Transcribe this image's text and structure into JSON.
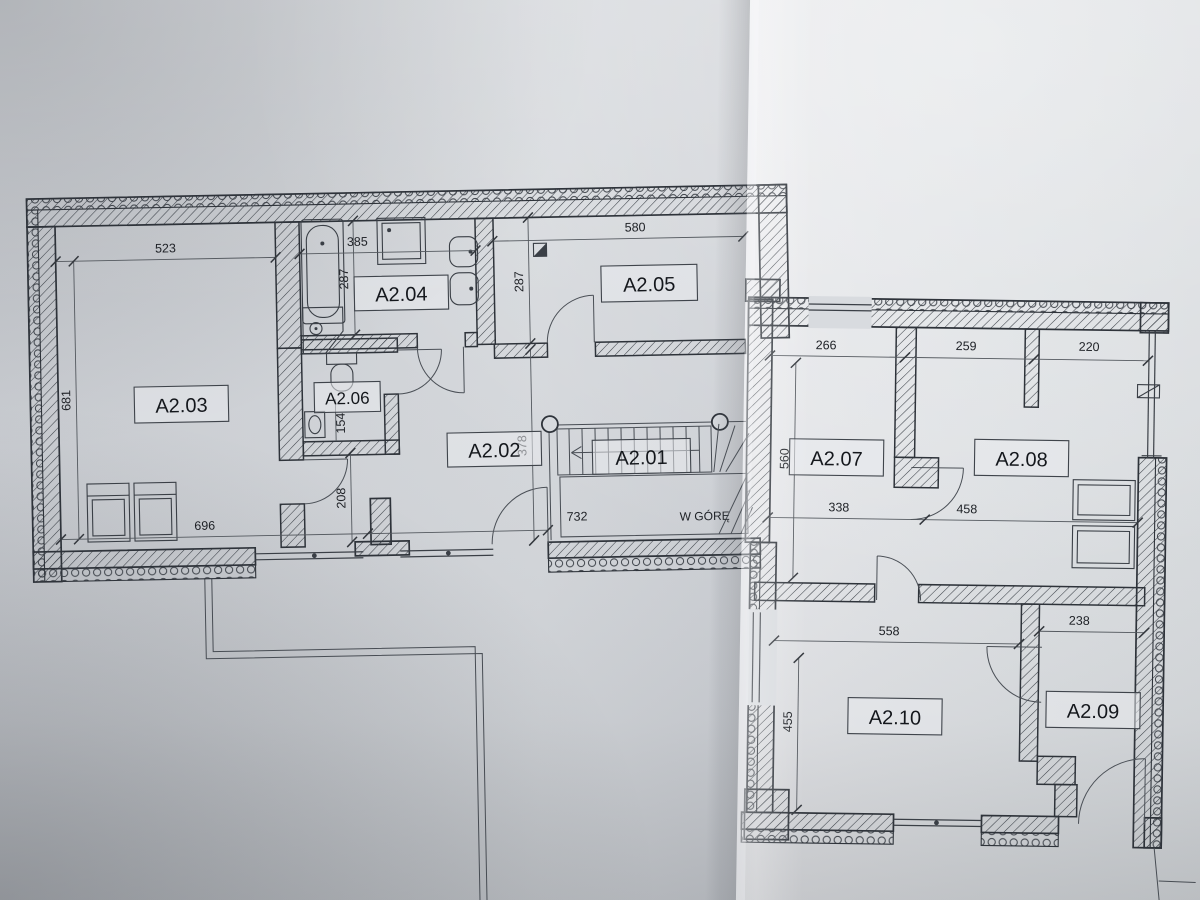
{
  "document": {
    "kind": "architectural-floor-plan-photo",
    "stair_note": "W GÓRĘ"
  },
  "colors": {
    "paper": "#d4d7db",
    "ink": "#2e333a",
    "dimension_text": "#1e2126"
  },
  "rooms": [
    {
      "label": "A2.01"
    },
    {
      "label": "A2.02"
    },
    {
      "label": "A2.03"
    },
    {
      "label": "A2.04"
    },
    {
      "label": "A2.05"
    },
    {
      "label": "A2.06"
    },
    {
      "label": "A2.07"
    },
    {
      "label": "A2.08"
    },
    {
      "label": "A2.09"
    },
    {
      "label": "A2.10"
    }
  ],
  "dimensions": {
    "a203_top": "523",
    "a203_left": "681",
    "a203_bottom": "696",
    "a204_top": "385",
    "a204_left": "287",
    "a205_top": "580",
    "a205_left": "287",
    "a206_width": "154",
    "hall_height": "378",
    "hall_left": "208",
    "stair_length": "732",
    "a207_top": "266",
    "a207_left": "560",
    "a207_bottom": "338",
    "a208_top_left": "259",
    "a208_top_right": "220",
    "a208_bottom": "458",
    "a210_top": "558",
    "a210_left": "455",
    "a209_top": "238"
  },
  "fixtures": [
    "bathtub-icon",
    "shower-icon",
    "washing-machine-icon",
    "sink-icon",
    "toilet-icon",
    "staircase-icon",
    "ventilation-box-icon",
    "radiator-icon",
    "wardrobe-icon",
    "armchair-icon",
    "column-icon"
  ]
}
